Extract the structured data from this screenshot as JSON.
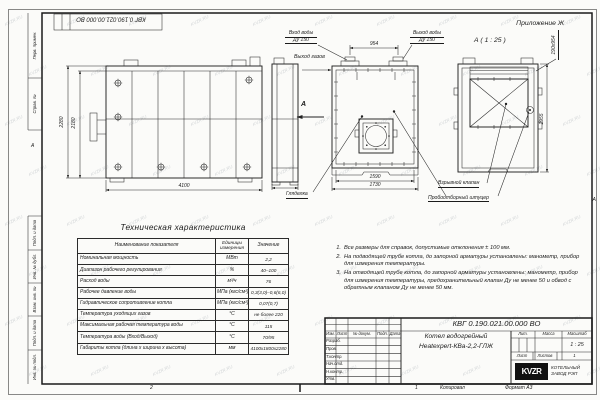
{
  "sheet": {
    "appendix": "Приложение Ж",
    "doc_number": "КВГ 0.190.021.00.000 ВО",
    "format_label": "Формат А3",
    "copy_label": "Копировал",
    "zone_2": "2",
    "zone_1": "1",
    "zone_a": "А",
    "watermark": "KVZR.RU",
    "frame_columns": {
      "perv": "Перв. примен.",
      "sprav": "Справ. №",
      "podp1": "Подп. и дата",
      "inv_dubl": "Инв. № дубл.",
      "vzam": "Взам. инв. №",
      "podp2": "Подп. и дата",
      "inv_podl": "Инв. № подл."
    }
  },
  "drawing": {
    "view_a_label": "А ( 1 : 25 )",
    "view_arrow": "А",
    "gas_outlet": "Выход газов",
    "water_inlet_line1": "Вход воды",
    "water_inlet_line2": "Ду 150",
    "water_outlet_line1": "Выход воды",
    "water_outlet_line2": "Ду 150",
    "peephole": "Гляделка",
    "explosion_valve": "Взрывной клапан",
    "sampling_fitting": "Пробоотборный штуцер",
    "dims": {
      "d954": "954",
      "d2280": "2280",
      "d2180": "2180",
      "d4100": "4100",
      "d1590": "1590",
      "d1730": "1730",
      "d1955": "1955",
      "d190x954": "190х954"
    }
  },
  "spec_table": {
    "title": "Техническая характеристика",
    "col_name": "Наименование показателя",
    "col_unit": "Единицы измерения",
    "col_value": "Значение",
    "rows": [
      {
        "name": "Номинальная мощность",
        "unit": "МВт",
        "value": "2,2"
      },
      {
        "name": "Диапазон рабочего регулирования",
        "unit": "%",
        "value": "40–100"
      },
      {
        "name": "Расход воды",
        "unit": "м³/ч",
        "value": "76"
      },
      {
        "name": "Рабочее давление воды",
        "unit": "МПа (кгс/см²)",
        "value": "0,3(3,0)–0,6(6,0)"
      },
      {
        "name": "Гидравлическое сопротивление котла",
        "unit": "МПа (кгс/см²)",
        "value": "0,07(0,7)"
      },
      {
        "name": "Температура уходящих газов",
        "unit": "°С",
        "value": "не более 220"
      },
      {
        "name": "Максимальная рабочая температура воды",
        "unit": "°С",
        "value": "115"
      },
      {
        "name": "Температура воды (Вход/Выход)",
        "unit": "°С",
        "value": "70/95"
      },
      {
        "name": "Габариты котла (длина х ширина х высота)",
        "unit": "мм",
        "value": "4100х1800х2280"
      }
    ]
  },
  "notes": [
    {
      "num": "1.",
      "text": "Все размеры для справок, допустимые отклонения ± 100 мм."
    },
    {
      "num": "2.",
      "text": "На подводящей трубе котла, до запорной арматуры установлены: манометр, прибор для измерения температуры."
    },
    {
      "num": "3.",
      "text": "На отводящей трубе котла, до запорной арматуры установлены: манометр, прибор для измерения температуры, предохранительный клапан Ду не менее 50 и обвод с обратным клапаном Ду не менее 50 мм."
    }
  ],
  "title_block": {
    "cols": {
      "izm": "Изм.",
      "list": "Лист",
      "doc": "№ докум.",
      "podp": "Подп.",
      "data": "Дата"
    },
    "rows": {
      "razrab": "Разраб.",
      "prov": "Пров.",
      "tkontr": "Т.контр.",
      "nachotd": "Нач.отд.",
      "nkontr": "Н.контр.",
      "utv": "Утв."
    },
    "name_line1": "Котел водогрейный",
    "name_line2": "Heatexpert-КВа-2,2-ГЛЖ",
    "lit_label": "Лит.",
    "mass_label": "Масса",
    "scale_label": "Масштаб",
    "scale_value": "1 : 25",
    "sheet_label": "Лист",
    "sheets_label": "Листов",
    "sheets_value": "1",
    "logo_text": "KVZR",
    "logo_line1": "КОТЕЛЬНЫЙ",
    "logo_line2": "ЗАВОД РЭП"
  }
}
